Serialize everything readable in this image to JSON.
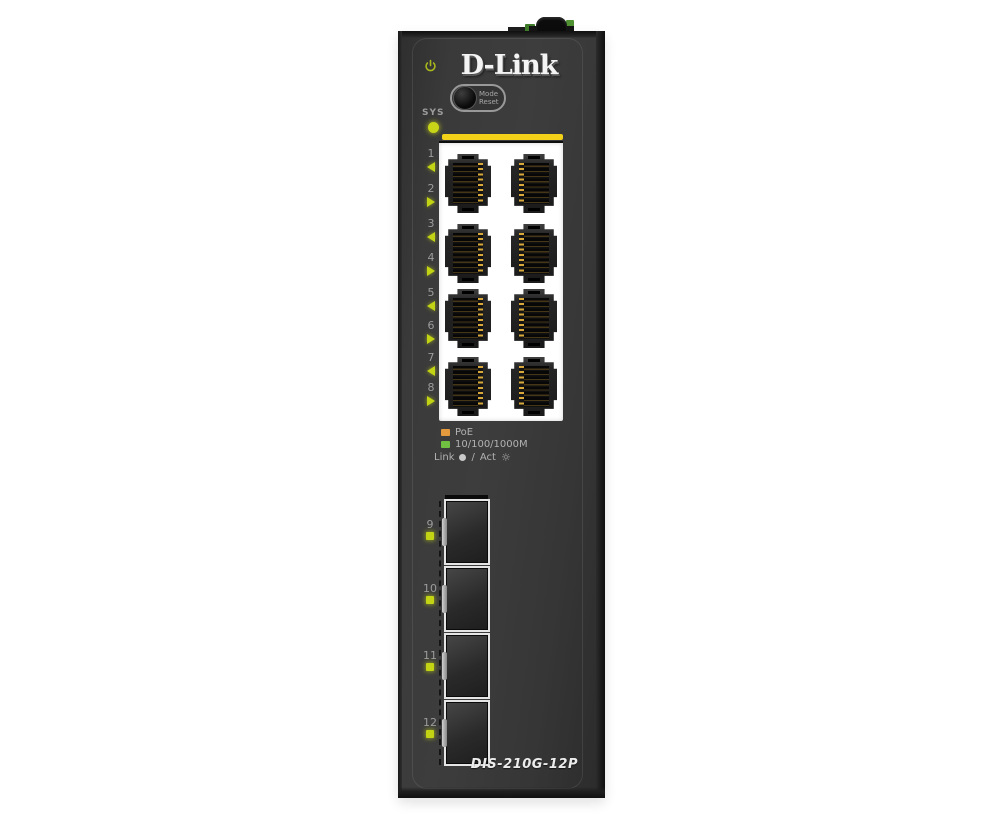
{
  "device": {
    "brand_logo": "D-Link",
    "model_label": "DIS-210G-12P",
    "sys_led_label": "SYS",
    "mode_reset_button": {
      "line1": "Mode",
      "line2": "Reset"
    }
  },
  "rj45_ports": [
    {
      "number": "1",
      "led_class": "tri-left"
    },
    {
      "number": "2",
      "led_class": "tri-right"
    },
    {
      "number": "3",
      "led_class": "tri-left"
    },
    {
      "number": "4",
      "led_class": "tri-right"
    },
    {
      "number": "5",
      "led_class": "tri-left"
    },
    {
      "number": "6",
      "led_class": "tri-right"
    },
    {
      "number": "7",
      "led_class": "tri-left"
    },
    {
      "number": "8",
      "led_class": "tri-right"
    }
  ],
  "sfp_ports": [
    {
      "number": "9"
    },
    {
      "number": "10"
    },
    {
      "number": "11"
    },
    {
      "number": "12"
    }
  ],
  "legend": {
    "items": [
      {
        "label": "PoE",
        "swatch_color": "#E59B3D"
      },
      {
        "label": "10/100/1000M",
        "swatch_color": "#70C041"
      }
    ],
    "link_act": {
      "link_label": "Link",
      "separator": "/",
      "act_label": "Act",
      "act_icon": "☼"
    }
  },
  "colors": {
    "chassis_face": "#383838",
    "port_panel": "#FFFFFF",
    "accent_bar": "#F2D118",
    "led_green_yellow": "#C8D418",
    "poe_orange": "#E59B3D",
    "speed_green": "#70C041",
    "label_text": "#9C9C9C"
  }
}
